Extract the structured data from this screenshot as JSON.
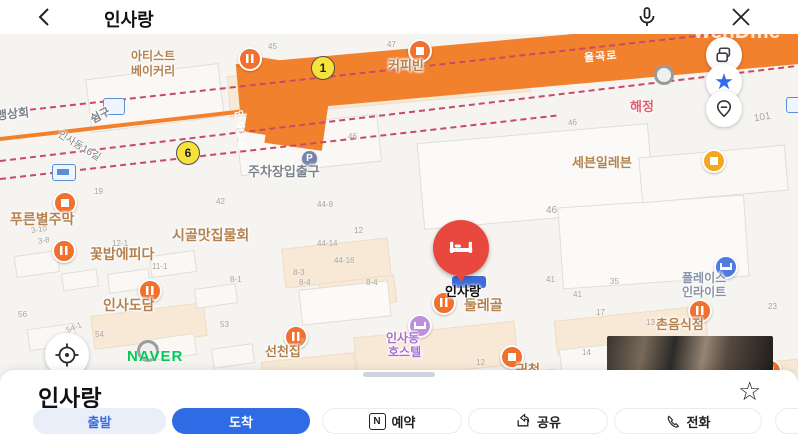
{
  "top_bar": {
    "title": "인사랑"
  },
  "watermark": "wehDme",
  "map": {
    "road_names": {
      "main": "율곡로",
      "branch": "인사동길",
      "street16": "인사동16길"
    },
    "exits": {
      "exit1": "1",
      "exit6": "6"
    },
    "labels": {
      "artist_bakery_1": "아티스트",
      "artist_bakery_2": "베이커리",
      "coffee_bean": "커피빈",
      "maeng_sanghoe": "맹상회",
      "shimgu": "쉼구",
      "haejeong": "해정",
      "seven_eleven": "세븐일레븐",
      "parking_entrance": "주차장입출구",
      "parking_badge": "P",
      "pureunbyeol_jumak": "푸른별주막",
      "sigol_matjip": "시골맛집물회",
      "kkotbap_epida": "꽃밥에피다",
      "insadodam": "인사도담",
      "pin_label": "인사랑",
      "dullegol": "둘레골",
      "place_inlight_1": "플레이스",
      "place_inlight_2": "인라이트",
      "chon_eumsikjeom": "촌음식점",
      "hostel_1": "인사동",
      "hostel_2": "호스텔",
      "seoncheonjip": "선천집",
      "gwicheon": "귀천",
      "num_853": "853",
      "naver_logo": "NAVER"
    },
    "numbers": [
      "45",
      "47",
      "46",
      "46",
      "46",
      "101",
      "42",
      "19",
      "3-10",
      "3-8",
      "12-1",
      "11-1",
      "12",
      "44-8",
      "44-14",
      "44-16",
      "8-3",
      "8-4",
      "8-4",
      "8-1",
      "41",
      "35",
      "41",
      "23",
      "56",
      "54-1",
      "54",
      "53",
      "17",
      "13",
      "14",
      "12",
      "7"
    ]
  },
  "icons": {
    "restaurant": "fork-bars",
    "cafe": "cup",
    "hotel": "bed",
    "convenience": "cup",
    "bookmark_star": "★",
    "favorite_star_outline": "☆",
    "close": "✕"
  },
  "bottom_sheet": {
    "title": "인사랑",
    "depart": "출발",
    "arrive": "도착",
    "reserve": "예약",
    "reserve_badge": "N",
    "share": "공유",
    "call": "전화"
  },
  "colors": {
    "road_orange": "#f2812e",
    "boundary_pink": "#c84a67",
    "accent_blue": "#2e6be5",
    "pin_red": "#e8483d",
    "naver_green": "#00cb59",
    "poi_orange": "#f2702d",
    "hostel_purple": "#bd8fdc"
  }
}
